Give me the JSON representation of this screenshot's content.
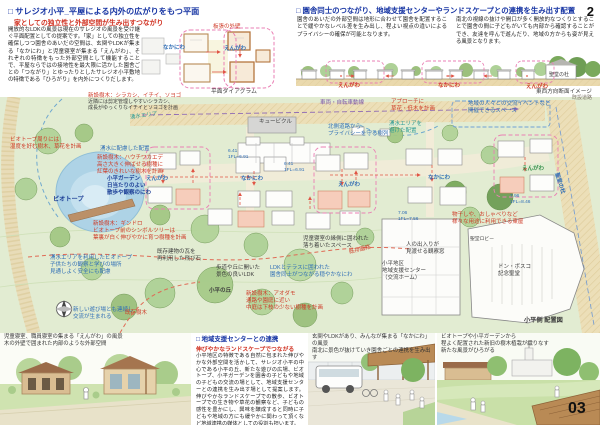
{
  "page": {
    "num_top": "2",
    "num_bottom": "03"
  },
  "plan_section": {
    "title": "□ サレジオ小平_平屋による内外の広がりをもつ平面",
    "subtitle": "家としての独立性と外部空間が生み出すつながり",
    "body": "開放的なLDKの風景は現在のサレジオの風景を受け継ぐ平面配置としての提案です。「家」としての独立性を確保しつつ園舎のあいだの空間は、玄関やLDKが集まる「なかにわ」と児童寝室が集まる「えんがわ」、それぞれの特徴をもった外部空間として機能することで、平屋ならではの接地性を最大限に活かした園舎ごとの「つながり」とゆったりとしたサレジオ小平敷地の特徴である「ひろがり」を内外につくりだします。",
    "diagram": {
      "wall_label": "板張の外壁",
      "nakaniwa": "なかにわ",
      "engawa": "えんがわ",
      "caption": "平面ダイアグラム"
    }
  },
  "layout_section": {
    "title": "□ 園舎同士のつながり、地域支援センターやランドスケープとの連携を生み出す配置",
    "body_left": "園舎のあいだの外部空間は地形に合わせて園舎を配置することで緩やかなレベル差を生み出し、程よい視点の違いによるプライバシーの確保が可能となります。",
    "body_right": "南北の視線の抜けや開口が多く開放的なつくりとすることで園舎の間に子どもがいても内部から確認することができ、友達を呼んで遊んだり、地域の方からも姿が見える風景となります。",
    "elevation": {
      "engawa1": "えんがわ",
      "nakaniwa": "なかにわ",
      "engawa2": "えんがわ",
      "mori": "聖堂の杜",
      "caption": "東西方向断面イメージ",
      "road": "既設道路"
    }
  },
  "site_plan": {
    "annotations": [
      {
        "text": "新設樹木：シラカシ、イチイ、ソヨゴ"
      },
      {
        "text": "近隣には剪定管理しやすいシラカシ、\n成長がゆっくりなイチイとソヨゴを計画"
      },
      {
        "text": "湧水エリア"
      },
      {
        "text": "ビオトープ周りには\n湿度を好む樹木、草花を計画"
      },
      {
        "text": "湧水に配慮した配置"
      },
      {
        "text": "新設樹木：ハウチワカエデ\n高さ大きく伸ばせる樹種に\n紅葉のきれいな樹木を計画"
      },
      {
        "text": "小平ガーデン\n日当たりのよい\n散歩や観察のにわ"
      },
      {
        "text": "ビオトープ"
      },
      {
        "text": "新設樹木：ギンドロ\nビオトープ前のシンボルツリーは\n葉裏が白く伸びやかに育つ樹種を計画"
      },
      {
        "text": "湧水エリアを利用したビオトープ\n子供たちの観察と学びの場所\n見通しよく安全にも配慮"
      },
      {
        "text": "既存建物の瓦を\n再利用した飛び石"
      },
      {
        "text": "新しい遊び場とも連続し\n交流が生まれる"
      },
      {
        "text": "既存樹木"
      },
      {
        "text": "歩道や丘に開いた\n景色の良いLDK"
      },
      {
        "text": "小平の丘"
      },
      {
        "text": "新設樹木：アオダモ\n通路や園庭に近い\n中庭は下枝の少ない樹種を計画"
      },
      {
        "text": "児童寝室の縁側に囲われた\n落ち着いたスペース"
      },
      {
        "text": "LDKとテラスに囲われた\n園舎同士がつながる穏やかなにわ"
      },
      {
        "text": "既存園路"
      },
      {
        "text": "車両・自転車動線"
      },
      {
        "text": "アプローチに\n草花・低木を計画"
      },
      {
        "text": "北側道路から\nプライバシーを守る樹列"
      },
      {
        "text": "湧水エリアを\n避けた配置"
      },
      {
        "text": "えんがわ"
      },
      {
        "text": "なかにわ"
      },
      {
        "text": "えんがわ"
      },
      {
        "text": "なかにわ"
      },
      {
        "text": "えんがわ"
      },
      {
        "text": "地域の人々との交流イベントなど\n開催できるスペース"
      },
      {
        "text": "聖堂の杜"
      },
      {
        "text": "7.96\n1FL=8.46"
      },
      {
        "text": "6.41\n1FL=6.91"
      },
      {
        "text": "6.41\n1FL=6.91"
      },
      {
        "text": "7.06\n1FL=7.56"
      },
      {
        "text": "物干しや、おしゃべりなど\n様々な用途に利用できる東屋"
      },
      {
        "text": "人の出入りが\n見渡せる観察窓"
      },
      {
        "text": "小平地区\n地域支援センター\n（交流ホーム）"
      },
      {
        "text": "ドン・ボスコ\n記念聖堂"
      },
      {
        "text": "聖堂ロビー"
      },
      {
        "text": "キュービクル"
      },
      {
        "text": "小平側 配置図"
      }
    ]
  },
  "center_section": {
    "title": "□ 地域支援センターとの連携",
    "subtitle": "伸びやかなランドスケープでつながる",
    "body": "小平地区の特徴である自然に包まれた伸びやかな外部空間を活かして、サレジオ小平の中心である小平の丘、新たな遊びの広場、ビオトープ、小平ガーデンを園舎の子どもや地域の子どもの交流の場として、地域支援センターとの連携を生み出す場として提案します。伸びやかなランドスケープでの散歩、ビオトープでの生き物や草花の観察など、子どもの感性を豊かにし、興味を醸成すると同時に子どもや地域の方にも緩やかに関わって頂くなど地域連携の媒体としての役割も担います。"
  },
  "perspectives": {
    "left": "児童寝室、職員寝室の集まる「えんがわ」の風景\n木の外壁で囲まれた内部のような外部空間",
    "center": "玄関やLDKがあり、みんなが集まる「なかにわ」の風景\n南北に景色が抜けていき園舎ごとの連携を生み出す",
    "right": "ビオトープや小平ガーデンから\n程よく配置された新旧の樹木植栽が織りなす\n新たな風景がひろがる"
  }
}
